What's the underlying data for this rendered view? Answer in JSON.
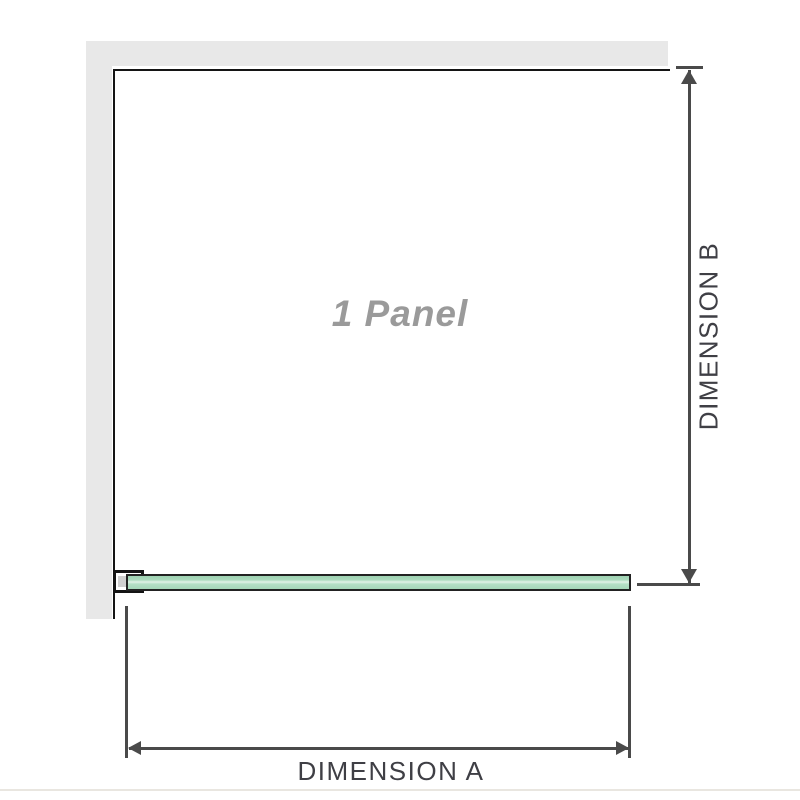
{
  "diagram": {
    "panel_label": "1 Panel",
    "dimensions": {
      "a_label": "DIMENSION A",
      "b_label": "DIMENSION B"
    },
    "colors": {
      "wall_fill": "#e8e8e8",
      "panel_outline": "#141414",
      "dimension_lines": "#4a4a4a",
      "dimension_text": "#3f3f45",
      "panel_label_text": "#9a9a9a",
      "glass_fill": "#abdabd",
      "glass_highlight": "#e2f2e7",
      "glass_outline": "#222222",
      "bracket_insert": "#cfcfcf",
      "bottom_rule": "#e9e6e0"
    }
  }
}
